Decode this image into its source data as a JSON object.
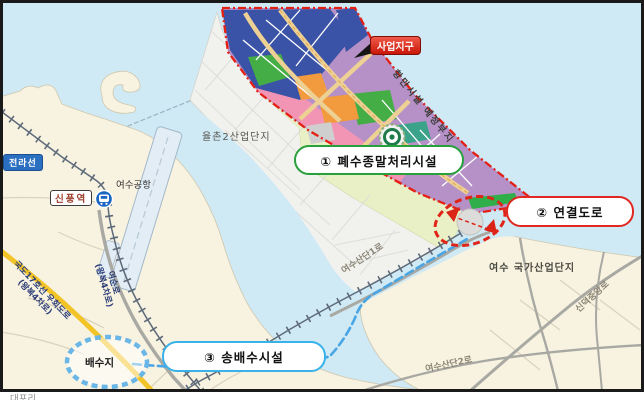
{
  "district": {
    "badge": "사업지구",
    "port_note": "항만시설 예정부지"
  },
  "facilities": {
    "f1": "① 폐수종말처리시설",
    "f2": "② 연결도로",
    "f3": "③ 송배수시설"
  },
  "places": {
    "jeolla_line": "전라선",
    "sinpung_station": "신풍역",
    "yeosu_airport": "여수공항",
    "yulchon2": "율촌2산업단지",
    "yeosu_national": "여수 국가산업단지",
    "reservoir": "배수지",
    "daepo_ri": "대포리"
  },
  "roads": {
    "national17_l1": "국도17호선 우회도로",
    "national17_l2": "(왕복4차로)",
    "yeosun_l1": "여순로",
    "yeosun_l2": "(왕복4차로)",
    "sandan1": "여수산단1로",
    "sandan2": "여수산단2로",
    "sindeok": "신덕중앙로"
  },
  "colors": {
    "sea": "#cfe9f5",
    "land": "#f8f2e0",
    "district_boundary": "#e42015",
    "parcel_blue": "#3b53a6",
    "parcel_purple": "#b691c8",
    "parcel_pink": "#f295b5",
    "parcel_green": "#44ad46",
    "parcel_orange": "#f29a3e",
    "facility1_border": "#28a03c",
    "facility2_border": "#e02820",
    "facility3_border": "#38b2e8",
    "pipeline_blue": "#49a5e3",
    "highway_yellow": "#f2c428"
  }
}
